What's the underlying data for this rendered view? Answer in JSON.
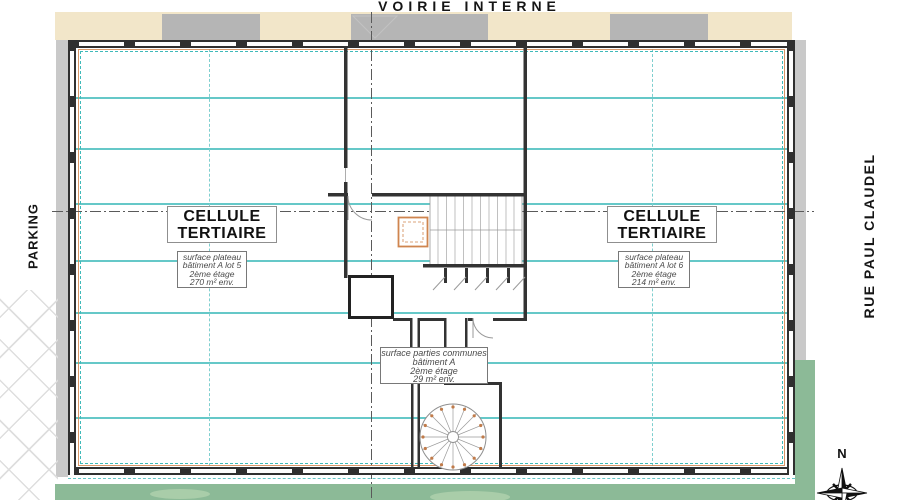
{
  "streets": {
    "top": "VOIRIE INTERNE",
    "left": "PARKING",
    "right": "RUE PAUL CLAUDEL"
  },
  "cells": {
    "left": {
      "name": "CELLULE TERTIAIRE",
      "info": [
        "surface plateau",
        "bâtiment A lot 5",
        "2ème étage",
        "270 m² env."
      ]
    },
    "right": {
      "name": "CELLULE TERTIAIRE",
      "info": [
        "surface plateau",
        "bâtiment A lot 6",
        "2ème étage",
        "214 m² env."
      ]
    }
  },
  "common_areas": {
    "info": [
      "surface parties communes",
      "bâtiment A",
      "2ème étage",
      "29 m² env."
    ]
  },
  "compass": {
    "north_label": "N"
  },
  "colors": {
    "grid_teal": "#3fbaba",
    "accent_orange": "#d0854f",
    "wall_dark": "#2f2f2f",
    "road_beige": "#f2e6c9",
    "canopy_gray": "#b5b5b5",
    "landscape_green": "#8cba97"
  }
}
